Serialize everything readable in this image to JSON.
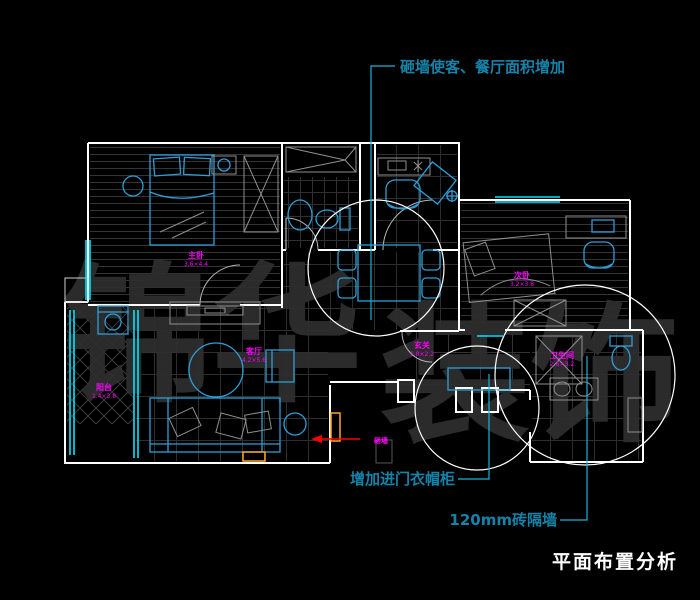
{
  "colors": {
    "bg": "#000000",
    "wall": "#ffffff",
    "furniture": "#2E9FD6",
    "window": "#00E5FF",
    "leader": "#19B4D6",
    "annotation": "#1583A9",
    "label": "#FF00FF",
    "red": "#FF0000",
    "orange": "#FFA520",
    "watermark": "#2e2e2e",
    "title": "#ffffff"
  },
  "watermark": {
    "left": "锦华",
    "right": "装饰"
  },
  "title": "平面布置分析",
  "annotations": {
    "top": "砸墙使客、餐厅面积增加",
    "closet": "增加进门衣帽柜",
    "partition": "120mm砖隔墙",
    "demolish_note": "砸墙"
  },
  "room_labels": [
    {
      "id": "master-bedroom",
      "name": "主卧",
      "dim": "3.6×4.4"
    },
    {
      "id": "balcony",
      "name": "阳台",
      "dim": "1.4×3.8"
    },
    {
      "id": "living-room",
      "name": "客厅",
      "dim": "4.2×5.6"
    },
    {
      "id": "second-bedroom",
      "name": "次卧",
      "dim": "3.2×3.8"
    },
    {
      "id": "bathroom",
      "name": "卫生间",
      "dim": "2.6×3.2"
    },
    {
      "id": "entry",
      "name": "玄关",
      "dim": "1.8×2.2"
    }
  ]
}
